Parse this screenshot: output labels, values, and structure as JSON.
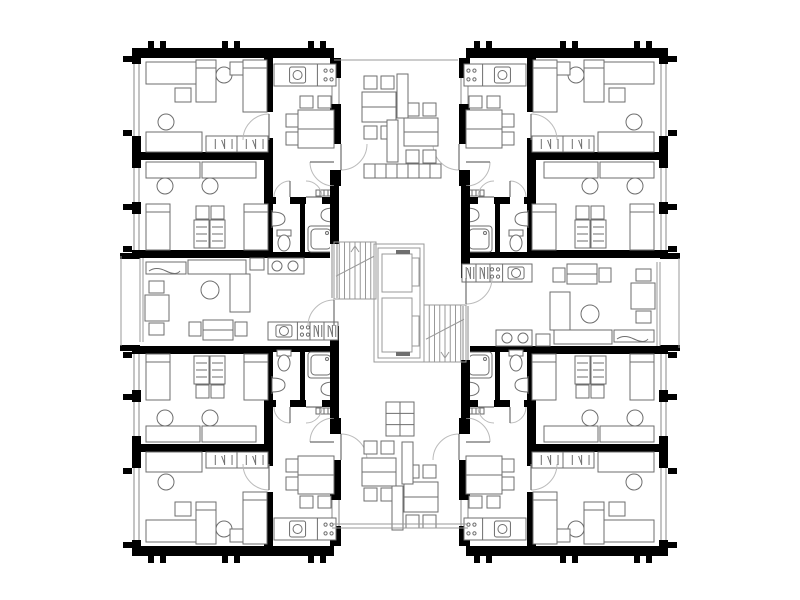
{
  "meta": {
    "label": "apartment-building-floor-plan",
    "width": 800,
    "height": 600
  },
  "colors": {
    "background": "#ffffff",
    "wall": "#000000",
    "furniture": "#6e6e6e",
    "thin": "#999999",
    "door": "#bbbbbb",
    "window": "#8a8a8a"
  },
  "symmetry": {
    "type": "point-and-mirror",
    "cx": 400,
    "cy": 302,
    "width": 800,
    "height": 604
  },
  "quad": {
    "walls": [
      [
        132,
        48,
        202,
        10
      ],
      [
        132,
        48,
        9,
        210
      ],
      [
        264,
        58,
        9,
        54
      ],
      [
        264,
        138,
        9,
        22
      ],
      [
        140,
        152,
        126,
        8
      ],
      [
        132,
        250,
        136,
        8
      ],
      [
        264,
        160,
        9,
        98
      ],
      [
        300,
        200,
        5,
        52
      ],
      [
        268,
        197,
        8,
        7
      ],
      [
        290,
        197,
        16,
        7
      ],
      [
        322,
        197,
        12,
        7
      ],
      [
        268,
        252,
        66,
        6
      ],
      [
        330,
        58,
        11,
        20
      ],
      [
        330,
        104,
        11,
        40
      ],
      [
        330,
        170,
        11,
        16
      ]
    ],
    "windows": [
      [
        132,
        64,
        9,
        72
      ],
      [
        132,
        168,
        9,
        34
      ],
      [
        132,
        214,
        9,
        36
      ],
      [
        330,
        78,
        11,
        26
      ]
    ],
    "ticks": [
      [
        123,
        56,
        9,
        6
      ],
      [
        123,
        130,
        9,
        6
      ],
      [
        123,
        204,
        9,
        6
      ],
      [
        123,
        246,
        9,
        6
      ],
      [
        148,
        41,
        6,
        7
      ],
      [
        160,
        41,
        6,
        7
      ],
      [
        222,
        41,
        6,
        7
      ],
      [
        234,
        41,
        6,
        7
      ],
      [
        308,
        41,
        6,
        7
      ],
      [
        320,
        41,
        6,
        7
      ]
    ],
    "doors": [
      [
        269,
        140,
        26,
        90,
        180
      ],
      [
        334,
        162,
        24,
        180,
        270
      ],
      [
        290,
        197,
        16,
        90,
        180
      ],
      [
        306,
        197,
        16,
        0,
        90
      ],
      [
        341,
        144,
        26,
        -90,
        0
      ]
    ],
    "furniture": [
      [
        "rect",
        146,
        62,
        50,
        22
      ],
      [
        "bed",
        196,
        60,
        20,
        42
      ],
      [
        "rect",
        175,
        88,
        16,
        14
      ],
      [
        "circle",
        224,
        75,
        8
      ],
      [
        "chair",
        230,
        62,
        16,
        13
      ],
      [
        "bed",
        243,
        60,
        24,
        52
      ],
      [
        "circle",
        166,
        122,
        8
      ],
      [
        "rect",
        146,
        132,
        56,
        20
      ],
      [
        "ward",
        206,
        136,
        62,
        16
      ],
      [
        "kit",
        274,
        64,
        62,
        22
      ],
      [
        "dtable",
        298,
        110,
        36,
        38
      ],
      [
        "chair",
        300,
        96,
        13,
        12
      ],
      [
        "chair",
        318,
        96,
        13,
        12
      ],
      [
        "chair",
        286,
        114,
        12,
        13
      ],
      [
        "chair",
        286,
        132,
        12,
        13
      ],
      [
        "rect",
        146,
        162,
        54,
        16
      ],
      [
        "rect",
        202,
        162,
        54,
        16
      ],
      [
        "circle",
        165,
        186,
        8
      ],
      [
        "circle",
        210,
        186,
        8
      ],
      [
        "bed",
        146,
        204,
        24,
        46
      ],
      [
        "bed",
        244,
        204,
        24,
        46
      ],
      [
        "chair",
        196,
        206,
        13,
        13
      ],
      [
        "chair",
        211,
        206,
        13,
        13
      ],
      [
        "mat",
        194,
        220,
        15,
        28
      ],
      [
        "mat",
        210,
        220,
        15,
        28
      ],
      [
        "sinkD",
        272,
        210,
        13,
        18,
        "w"
      ],
      [
        "wc",
        284,
        242
      ],
      [
        "sinkD",
        321,
        206,
        13,
        18,
        "e"
      ],
      [
        "shower",
        308,
        226,
        26,
        26
      ],
      [
        "radiator",
        316,
        190,
        16,
        6
      ]
    ]
  },
  "half": {
    "walls": [
      [
        330,
        186,
        9,
        58
      ],
      [
        330,
        326,
        9,
        92
      ],
      [
        120,
        253,
        20,
        6
      ],
      [
        120,
        345,
        20,
        6
      ]
    ],
    "windows": [
      [
        330,
        244,
        9,
        54
      ]
    ],
    "lines": [
      [
        121,
        256,
        121,
        346
      ],
      [
        140,
        258,
        140,
        342
      ],
      [
        143,
        258,
        143,
        342
      ]
    ],
    "doors": [
      [
        334,
        326,
        26,
        90,
        180
      ]
    ],
    "furniture": [
      [
        "bench",
        146,
        262,
        40,
        12
      ],
      [
        "sofa",
        188,
        260,
        58,
        14
      ],
      [
        "sofa",
        230,
        274,
        20,
        38
      ],
      [
        "chair",
        250,
        258,
        14,
        12
      ],
      [
        "circle",
        210,
        290,
        9
      ],
      [
        "rect",
        145,
        295,
        24,
        26
      ],
      [
        "chair",
        149,
        281,
        15,
        12
      ],
      [
        "chair",
        149,
        323,
        15,
        12
      ],
      [
        "dtable",
        203,
        320,
        30,
        20
      ],
      [
        "chair",
        189,
        322,
        12,
        14
      ],
      [
        "chair",
        235,
        322,
        12,
        14
      ],
      [
        "kit",
        268,
        322,
        42,
        18
      ],
      [
        "ward",
        310,
        322,
        28,
        18
      ],
      [
        "rect",
        268,
        258,
        36,
        16
      ],
      [
        "circle",
        277,
        266,
        5
      ],
      [
        "circle",
        293,
        266,
        5
      ],
      [
        "stair",
        334,
        242,
        42,
        57,
        "up"
      ],
      [
        "dtable",
        362,
        92,
        34,
        30
      ],
      [
        "chair",
        364,
        76,
        13,
        13
      ],
      [
        "chair",
        381,
        76,
        13,
        13
      ],
      [
        "chair",
        364,
        126,
        13,
        13
      ],
      [
        "chair",
        381,
        126,
        13,
        13
      ],
      [
        "dtable",
        404,
        118,
        34,
        28
      ],
      [
        "chair",
        406,
        103,
        13,
        13
      ],
      [
        "chair",
        423,
        103,
        13,
        13
      ],
      [
        "chair",
        406,
        150,
        13,
        13
      ],
      [
        "chair",
        423,
        150,
        13,
        13
      ],
      [
        "screen",
        397,
        74,
        11,
        44
      ],
      [
        "screen",
        387,
        120,
        11,
        42
      ]
    ]
  },
  "static": {
    "lines": [
      [
        334,
        60,
        458,
        60
      ],
      [
        332,
        524,
        468,
        524
      ],
      [
        332,
        528,
        468,
        528
      ]
    ],
    "thinrects": [
      [
        374,
        244,
        50,
        118
      ],
      [
        378,
        248,
        42,
        110
      ],
      [
        382,
        254,
        30,
        38
      ],
      [
        382,
        298,
        30,
        54
      ],
      [
        412,
        258,
        7,
        28
      ],
      [
        412,
        316,
        7,
        30
      ]
    ],
    "darkrects": [
      [
        396,
        250,
        14,
        4
      ],
      [
        396,
        352,
        14,
        4
      ]
    ],
    "planter_row": [
      364,
      164,
      7,
      11,
      14
    ],
    "grid": [
      386,
      402,
      28,
      34,
      2,
      3
    ]
  }
}
